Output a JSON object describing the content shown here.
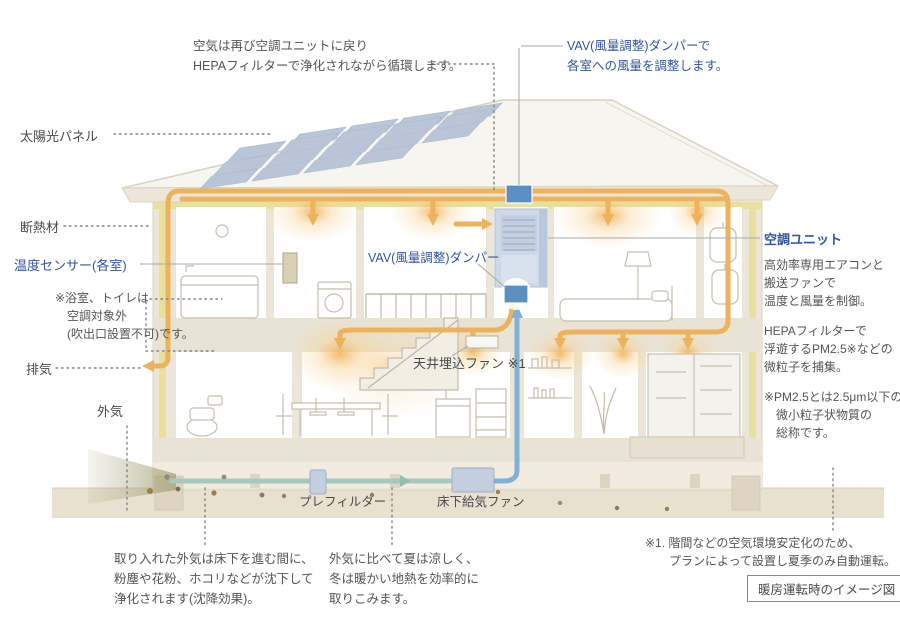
{
  "notes": {
    "circulation": "空気は再び空調ユニットに戻り\nHEPAフィルターで浄化されながら循環します。",
    "vav_top": "VAV(風量調整)ダンパーで\n各室への風量を調整します。",
    "bath_note": "※浴室、トイレは\n　空調対象外\n　(吹出口設置不可)です。",
    "bottom_left": "取り入れた外気は床下を進む間に、\n粉塵や花粉、ホコリなどが沈下して\n浄化されます(沈降効果)。",
    "bottom_middle": "外気に比べて夏は涼しく、\n冬は暖かい地熱を効率的に\n取りこみます。",
    "note1": "※1. 階間などの空気環境安定化のため、\n　　プランによって設置し夏季のみ自動運転。",
    "caption": "暖房運転時のイメージ図"
  },
  "labels": {
    "solar": "太陽光パネル",
    "insulation": "断熱材",
    "temp_sensor": "温度センサー(各室)",
    "exhaust": "排気",
    "outside_air": "外気",
    "vav_mid": "VAV(風量調整)ダンパー",
    "ceiling_fan": "天井埋込ファン ※1",
    "prefilter": "プレフィルター",
    "underfloor_fan": "床下給気ファン"
  },
  "ac_panel": {
    "title": "空調ユニット",
    "body1": "高効率専用エアコンと\n搬送ファンで\n温度と風量を制御。",
    "body2": "HEPAフィルターで\n浮遊するPM2.5※などの\n微粒子を捕集。",
    "note": "※PM2.5とは2.5μm以下の\n　微小粒子状物質の\n　総称です。"
  },
  "colors": {
    "warm_air": "#ecb35c",
    "supply_air": "#7fb0d6",
    "fresh_air": "#a6c9bd",
    "accent_blue": "#33549f",
    "insulation_yellow": "#e9df9f",
    "damper_blue": "#5b8fc2"
  }
}
